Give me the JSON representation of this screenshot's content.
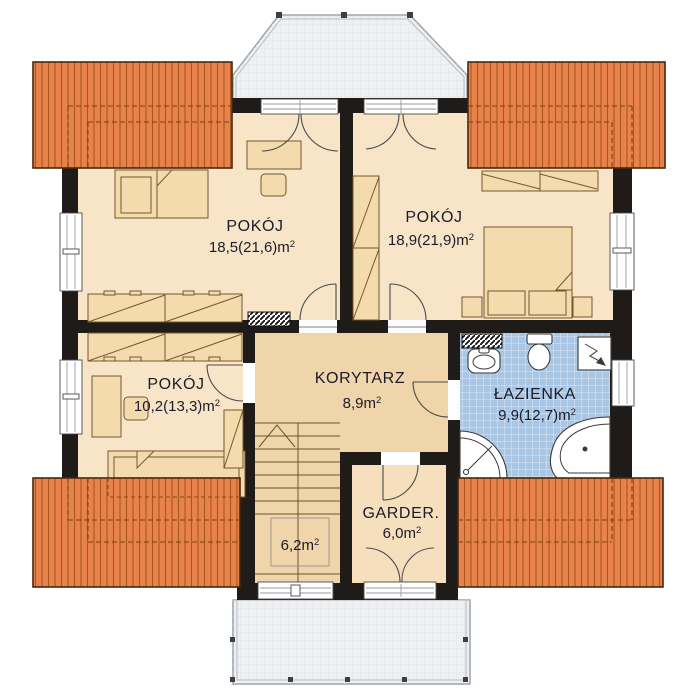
{
  "plan": {
    "type": "architectural-floor-plan",
    "rooms": [
      {
        "key": "pokoj-1",
        "name": "POKÓJ",
        "area": "18,5(21,6)m",
        "sup": "2"
      },
      {
        "key": "pokoj-2",
        "name": "POKÓJ",
        "area": "18,9(21,9)m",
        "sup": "2"
      },
      {
        "key": "pokoj-3",
        "name": "POKÓJ",
        "area": "10,2(13,3)m",
        "sup": "2"
      },
      {
        "key": "korytarz",
        "name": "KORYTARZ",
        "area": "8,9m",
        "sup": "2"
      },
      {
        "key": "lazienka",
        "name": "ŁAZIENKA",
        "area": "9,9(12,7)m",
        "sup": "2"
      },
      {
        "key": "garderoba",
        "name": "GARDER.",
        "area": "6,0m",
        "sup": "2"
      },
      {
        "key": "schody",
        "name": "",
        "area": "6,2m",
        "sup": "2"
      }
    ],
    "colors": {
      "roof": "#E8824B",
      "roof_stripe": "#A8571F",
      "wall": "#1E1B18",
      "room_floor": "#F8E5C8",
      "hall_floor": "#F0D5AA",
      "garder_floor": "#F5DFBC",
      "bath_floor": "#A9C7E5",
      "furniture": "#F3DBAD",
      "balcony": "#EEF0F2",
      "text": "#1B1B2B"
    }
  }
}
